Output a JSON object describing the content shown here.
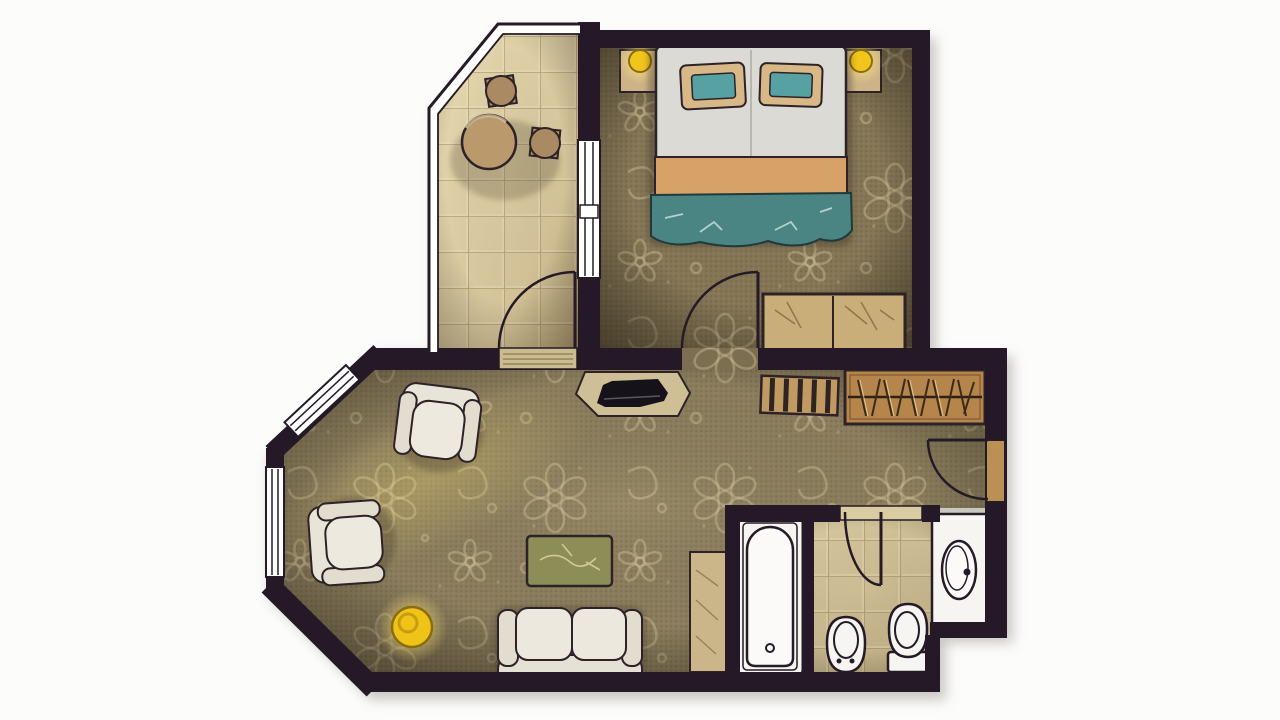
{
  "image": {
    "kind": "hand-rendered top-down floor plan of a hotel suite",
    "style": "watercolor sketch, no visible text labels"
  },
  "palette": {
    "bg": "#fcfcfb",
    "wall": "#251827",
    "outline": "#241b26",
    "carpetBase": "#877957",
    "carpetEdge": "#4c4434",
    "lace": "#e9dcae",
    "tileLight": "#e3d5ac",
    "tileDark": "#b4a176",
    "bathTileLight": "#d9c9a0",
    "bathTileDark": "#bcab80",
    "fixture": "#f6f5f1",
    "upholstery": "#e9e4d8",
    "duvet": "#dcdad5",
    "runner": "#d7a268",
    "blanket": "#4a8584",
    "pillowFrame": "#d9b888",
    "pillowTeal": "#57a1a2",
    "lampYellow": "#f2c51c",
    "wood": "#b5854b",
    "rackWood": "#c09a62",
    "stone": "#c9ae7a",
    "tableGreen": "#8d8d58",
    "consoleWood": "#cfbf96",
    "tvBlack": "#16121a",
    "doorLeaf": "#bb9055",
    "windowGlass": "#ffffff"
  },
  "rooms": [
    {
      "name": "bedroom",
      "furniture": [
        "double-bed",
        "pillow-left",
        "pillow-right",
        "nightstand-left",
        "nightstand-right",
        "bedside-lamp-left",
        "bedside-lamp-right",
        "storage-bench"
      ]
    },
    {
      "name": "balcony",
      "furniture": [
        "round-table",
        "stool-top",
        "stool-right"
      ]
    },
    {
      "name": "living-room",
      "furniture": [
        "armchair-top",
        "armchair-left",
        "floor-lamp",
        "coffee-table",
        "loveseat-sofa",
        "tv-console",
        "tv",
        "side-cabinet"
      ]
    },
    {
      "name": "entry-hall",
      "furniture": [
        "luggage-rack",
        "open-wardrobe",
        "entrance-door"
      ]
    },
    {
      "name": "bathroom",
      "furniture": [
        "bathtub",
        "bidet",
        "toilet",
        "sink-vanity"
      ]
    }
  ],
  "doors": [
    "balcony-door",
    "bedroom-door",
    "entrance-door",
    "bathroom-door"
  ],
  "windows": [
    "bay-window-diagonal",
    "bay-window-left",
    "balcony-bedroom-window",
    "balcony-railing"
  ]
}
